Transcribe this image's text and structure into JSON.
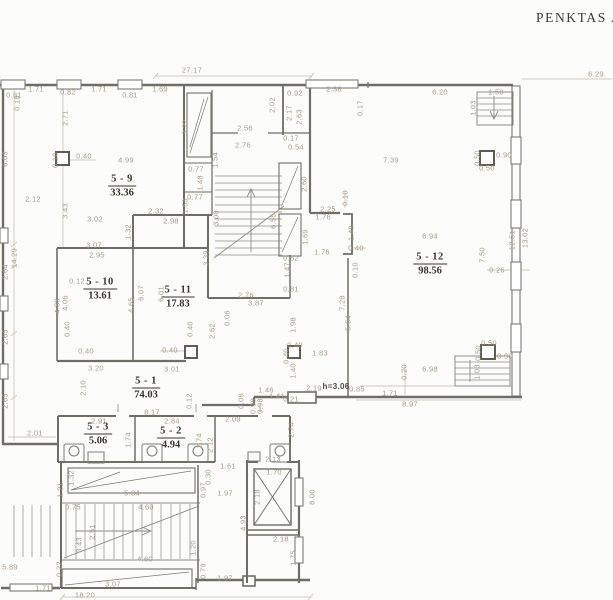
{
  "title": "PENKTAS AUK",
  "colors": {
    "background": "#fcfcfa",
    "wall": "#6e6e66",
    "thin_line": "#8d8d85",
    "dim_line": "#c2baae",
    "dim_text": "#a59c8e",
    "room_text": "#3a362f"
  },
  "rooms": [
    {
      "id": "5 - 9",
      "area": "33.36",
      "x": 122,
      "y": 186
    },
    {
      "id": "5 - 10",
      "area": "13.61",
      "x": 100,
      "y": 289
    },
    {
      "id": "5 - 11",
      "area": "17.83",
      "x": 178,
      "y": 297
    },
    {
      "id": "5 - 12",
      "area": "98.56",
      "x": 430,
      "y": 264
    },
    {
      "id": "5 - 1",
      "area": "74.03",
      "x": 146,
      "y": 388
    },
    {
      "id": "5 - 3",
      "area": "5.06",
      "x": 98,
      "y": 434
    },
    {
      "id": "5 - 2",
      "area": "4.94",
      "x": 171,
      "y": 438
    }
  ],
  "dimensions": [
    {
      "t": "0.81",
      "x": 14,
      "y": 95
    },
    {
      "t": "1.71",
      "x": 36,
      "y": 89
    },
    {
      "t": "0.82",
      "x": 68,
      "y": 92
    },
    {
      "t": "1.71",
      "x": 99,
      "y": 89
    },
    {
      "t": "0.81",
      "x": 130,
      "y": 95
    },
    {
      "t": "1.69",
      "x": 160,
      "y": 89
    },
    {
      "t": "27.17",
      "x": 192,
      "y": 70
    },
    {
      "t": "0.92",
      "x": 295,
      "y": 93
    },
    {
      "t": "2.38",
      "x": 334,
      "y": 89
    },
    {
      "t": "6.20",
      "x": 440,
      "y": 92
    },
    {
      "t": "6.29",
      "x": 596,
      "y": 74
    },
    {
      "t": "1.50",
      "x": 496,
      "y": 92
    },
    {
      "t": "0.18",
      "x": 17,
      "y": 103,
      "v": 1
    },
    {
      "t": "2.71",
      "x": 65,
      "y": 118,
      "v": 1
    },
    {
      "t": "6.03",
      "x": 5,
      "y": 159,
      "v": 1
    },
    {
      "t": "14.29",
      "x": 14,
      "y": 258,
      "v": 1
    },
    {
      "t": "2.64",
      "x": 5,
      "y": 272,
      "v": 1
    },
    {
      "t": "2.65",
      "x": 5,
      "y": 337,
      "v": 1
    },
    {
      "t": "2.65",
      "x": 5,
      "y": 401,
      "v": 1
    },
    {
      "t": "3.22",
      "x": 185,
      "y": 127,
      "v": 1
    },
    {
      "t": "2.02",
      "x": 272,
      "y": 105,
      "v": 1
    },
    {
      "t": "2.17",
      "x": 289,
      "y": 113,
      "v": 1
    },
    {
      "t": "2.63",
      "x": 299,
      "y": 117,
      "v": 1
    },
    {
      "t": "2.56",
      "x": 245,
      "y": 128
    },
    {
      "t": "2.76",
      "x": 243,
      "y": 145
    },
    {
      "t": "0.17",
      "x": 291,
      "y": 138
    },
    {
      "t": "0.54",
      "x": 296,
      "y": 147
    },
    {
      "t": "0.17",
      "x": 360,
      "y": 108,
      "v": 1
    },
    {
      "t": "7.39",
      "x": 391,
      "y": 160
    },
    {
      "t": "1.03",
      "x": 473,
      "y": 108,
      "v": 1
    },
    {
      "t": "0.90",
      "x": 504,
      "y": 155
    },
    {
      "t": "0.50",
      "x": 477,
      "y": 158,
      "v": 1
    },
    {
      "t": "0.50",
      "x": 487,
      "y": 168
    },
    {
      "t": "1.54",
      "x": 215,
      "y": 160,
      "v": 1
    },
    {
      "t": "0.77",
      "x": 196,
      "y": 169
    },
    {
      "t": "1.48",
      "x": 200,
      "y": 183,
      "v": 1
    },
    {
      "t": "0.77",
      "x": 195,
      "y": 197
    },
    {
      "t": "2.60",
      "x": 304,
      "y": 184,
      "v": 1
    },
    {
      "t": "0.40",
      "x": 84,
      "y": 156
    },
    {
      "t": "0.10",
      "x": 55,
      "y": 160,
      "v": 1
    },
    {
      "t": "4.99",
      "x": 126,
      "y": 160
    },
    {
      "t": "2.12",
      "x": 33,
      "y": 199
    },
    {
      "t": "3.43",
      "x": 65,
      "y": 211,
      "v": 1
    },
    {
      "t": "3.02",
      "x": 95,
      "y": 219
    },
    {
      "t": "1.32",
      "x": 128,
      "y": 232,
      "v": 1
    },
    {
      "t": "2.32",
      "x": 156,
      "y": 211
    },
    {
      "t": "2.98",
      "x": 171,
      "y": 221
    },
    {
      "t": "1.53",
      "x": 185,
      "y": 206,
      "v": 1
    },
    {
      "t": "3.00",
      "x": 216,
      "y": 218,
      "v": 1
    },
    {
      "t": "3.39",
      "x": 206,
      "y": 258,
      "v": 1
    },
    {
      "t": "6.55",
      "x": 273,
      "y": 221,
      "v": 1
    },
    {
      "t": "1.69",
      "x": 305,
      "y": 237,
      "v": 1
    },
    {
      "t": "0.82",
      "x": 291,
      "y": 258
    },
    {
      "t": "1.47",
      "x": 287,
      "y": 270,
      "v": 1
    },
    {
      "t": "0.81",
      "x": 291,
      "y": 289
    },
    {
      "t": "3.07",
      "x": 94,
      "y": 245
    },
    {
      "t": "2.95",
      "x": 97,
      "y": 255
    },
    {
      "t": "0.12",
      "x": 77,
      "y": 281
    },
    {
      "t": "4.88",
      "x": 57,
      "y": 306,
      "v": 1
    },
    {
      "t": "4.06",
      "x": 65,
      "y": 303,
      "v": 1
    },
    {
      "t": "4.65",
      "x": 131,
      "y": 305,
      "v": 1
    },
    {
      "t": "6.07",
      "x": 141,
      "y": 293,
      "v": 1
    },
    {
      "t": "6.01",
      "x": 161,
      "y": 294,
      "v": 1
    },
    {
      "t": "2.76",
      "x": 246,
      "y": 295
    },
    {
      "t": "3.87",
      "x": 256,
      "y": 303
    },
    {
      "t": "0.06",
      "x": 227,
      "y": 318,
      "v": 1
    },
    {
      "t": "0.40",
      "x": 190,
      "y": 329,
      "v": 1
    },
    {
      "t": "0.40",
      "x": 67,
      "y": 329,
      "v": 1
    },
    {
      "t": "2.62",
      "x": 212,
      "y": 331,
      "v": 1
    },
    {
      "t": "1.98",
      "x": 293,
      "y": 325,
      "v": 1
    },
    {
      "t": "0.10",
      "x": 345,
      "y": 198,
      "v": 1
    },
    {
      "t": "2.25",
      "x": 328,
      "y": 209
    },
    {
      "t": "1.76",
      "x": 323,
      "y": 217
    },
    {
      "t": "1.49",
      "x": 351,
      "y": 233,
      "v": 1
    },
    {
      "t": "0.40",
      "x": 356,
      "y": 248
    },
    {
      "t": "0.10",
      "x": 355,
      "y": 270,
      "v": 1
    },
    {
      "t": "1.76",
      "x": 322,
      "y": 252
    },
    {
      "t": "6.94",
      "x": 430,
      "y": 236
    },
    {
      "t": "7.28",
      "x": 342,
      "y": 303,
      "v": 1
    },
    {
      "t": "5.64",
      "x": 348,
      "y": 323,
      "v": 1
    },
    {
      "t": "7.50",
      "x": 482,
      "y": 255,
      "v": 1
    },
    {
      "t": "12.51",
      "x": 512,
      "y": 240,
      "v": 1
    },
    {
      "t": "13.02",
      "x": 525,
      "y": 238,
      "v": 1
    },
    {
      "t": "0.26",
      "x": 497,
      "y": 270
    },
    {
      "t": "0.40",
      "x": 86,
      "y": 351
    },
    {
      "t": "3.20",
      "x": 96,
      "y": 368
    },
    {
      "t": "2.10",
      "x": 83,
      "y": 388,
      "v": 1
    },
    {
      "t": "0.40",
      "x": 170,
      "y": 350
    },
    {
      "t": "3.01",
      "x": 172,
      "y": 369
    },
    {
      "t": "0.40",
      "x": 295,
      "y": 345
    },
    {
      "t": "0.40",
      "x": 286,
      "y": 356,
      "v": 1
    },
    {
      "t": "1.40",
      "x": 293,
      "y": 371,
      "v": 1
    },
    {
      "t": "1.83",
      "x": 320,
      "y": 353
    },
    {
      "t": "2.19",
      "x": 314,
      "y": 388
    },
    {
      "t": "h=3.06",
      "x": 336,
      "y": 387,
      "b": 1
    },
    {
      "t": "0.85",
      "x": 357,
      "y": 389
    },
    {
      "t": "1.71",
      "x": 390,
      "y": 393
    },
    {
      "t": "0.20",
      "x": 404,
      "y": 372,
      "v": 1
    },
    {
      "t": "6.98",
      "x": 430,
      "y": 369
    },
    {
      "t": "8.97",
      "x": 410,
      "y": 404
    },
    {
      "t": "1.46",
      "x": 266,
      "y": 390
    },
    {
      "t": "1.41",
      "x": 277,
      "y": 396
    },
    {
      "t": "0.21",
      "x": 291,
      "y": 399
    },
    {
      "t": "0.06",
      "x": 241,
      "y": 401,
      "v": 1
    },
    {
      "t": "0.98",
      "x": 253,
      "y": 406,
      "v": 1
    },
    {
      "t": "0.98",
      "x": 260,
      "y": 406,
      "v": 1
    },
    {
      "t": "2.09",
      "x": 233,
      "y": 419
    },
    {
      "t": "0.12",
      "x": 189,
      "y": 401,
      "v": 1
    },
    {
      "t": "8.17",
      "x": 152,
      "y": 412
    },
    {
      "t": "2.01",
      "x": 35,
      "y": 433
    },
    {
      "t": "2.91",
      "x": 99,
      "y": 421
    },
    {
      "t": "1.74",
      "x": 128,
      "y": 440,
      "v": 1
    },
    {
      "t": "2.84",
      "x": 172,
      "y": 421
    },
    {
      "t": "1.74",
      "x": 199,
      "y": 441,
      "v": 1
    },
    {
      "t": "2.12",
      "x": 210,
      "y": 445,
      "v": 1
    },
    {
      "t": "2.74",
      "x": 291,
      "y": 430,
      "v": 1
    },
    {
      "t": "0.50",
      "x": 489,
      "y": 343
    },
    {
      "t": "0.50",
      "x": 478,
      "y": 353,
      "v": 1
    },
    {
      "t": "0.90",
      "x": 505,
      "y": 356
    },
    {
      "t": "1.03",
      "x": 477,
      "y": 372,
      "v": 1
    },
    {
      "t": "2.13",
      "x": 273,
      "y": 459
    },
    {
      "t": "1.70",
      "x": 274,
      "y": 472
    },
    {
      "t": "1.61",
      "x": 228,
      "y": 466
    },
    {
      "t": "0.30",
      "x": 208,
      "y": 477,
      "v": 1
    },
    {
      "t": "0.97",
      "x": 203,
      "y": 490,
      "v": 1
    },
    {
      "t": "1.97",
      "x": 225,
      "y": 493
    },
    {
      "t": "2.18",
      "x": 257,
      "y": 497,
      "v": 1
    },
    {
      "t": "4.93",
      "x": 243,
      "y": 523,
      "v": 1
    },
    {
      "t": "8.00",
      "x": 312,
      "y": 497,
      "v": 1
    },
    {
      "t": "1.32",
      "x": 71,
      "y": 478,
      "v": 1
    },
    {
      "t": "1.21",
      "x": 60,
      "y": 490,
      "v": 1
    },
    {
      "t": "5.04",
      "x": 132,
      "y": 493
    },
    {
      "t": "0.75",
      "x": 73,
      "y": 507
    },
    {
      "t": "4.60",
      "x": 146,
      "y": 507
    },
    {
      "t": "2.51",
      "x": 92,
      "y": 532,
      "v": 1
    },
    {
      "t": "3.43",
      "x": 79,
      "y": 545,
      "v": 1
    },
    {
      "t": "1.20",
      "x": 193,
      "y": 548,
      "v": 1
    },
    {
      "t": "4.60",
      "x": 145,
      "y": 559
    },
    {
      "t": "2.18",
      "x": 281,
      "y": 539
    },
    {
      "t": "1.75",
      "x": 293,
      "y": 558,
      "v": 1
    },
    {
      "t": "5.89",
      "x": 10,
      "y": 567
    },
    {
      "t": "0.22",
      "x": 59,
      "y": 569,
      "v": 1
    },
    {
      "t": "1.71",
      "x": 43,
      "y": 588
    },
    {
      "t": "3.07",
      "x": 113,
      "y": 584
    },
    {
      "t": "0.79",
      "x": 203,
      "y": 571,
      "v": 1
    },
    {
      "t": "1.97",
      "x": 225,
      "y": 578
    },
    {
      "t": "18.20",
      "x": 85,
      "y": 595
    }
  ]
}
